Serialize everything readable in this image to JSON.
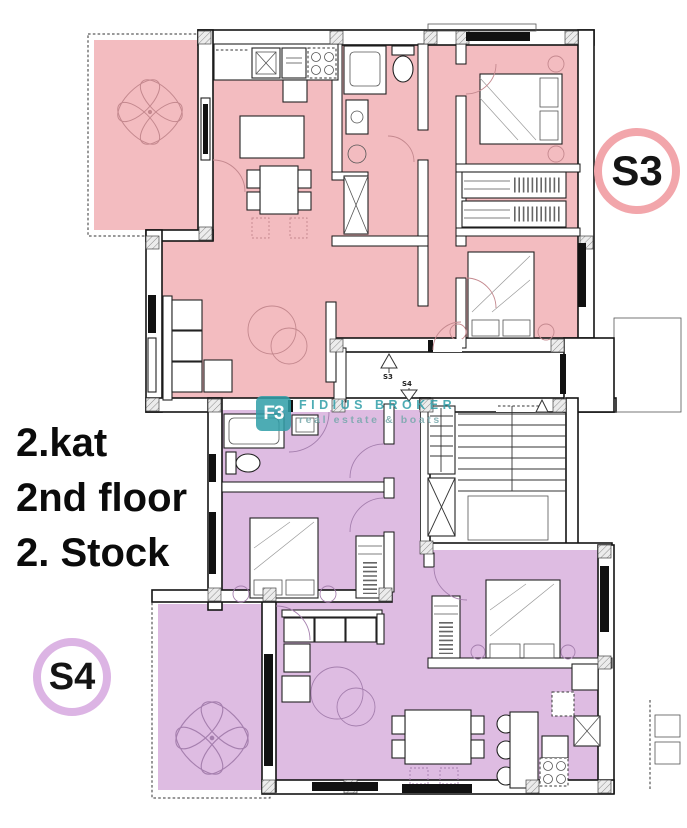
{
  "theme": {
    "pink": "#f3bcc0",
    "pink-ring": "#f2a6ab",
    "purple": "#debce2",
    "purple-ring": "#dcb4e4",
    "teal": "#2f9ea8",
    "teal-sub": "#76a8ab",
    "ink": "#111111"
  },
  "floor_labels": {
    "line1": "2.kat",
    "line2": "2nd floor",
    "line3": "2. Stock"
  },
  "badges": {
    "s3": "S3",
    "s4": "S4"
  },
  "corridor": {
    "up_label": "S3",
    "down_label": "S4"
  },
  "watermark": {
    "logo": "F3",
    "title": "FIDIUS BROKER",
    "subtitle": "real estate & boats"
  }
}
